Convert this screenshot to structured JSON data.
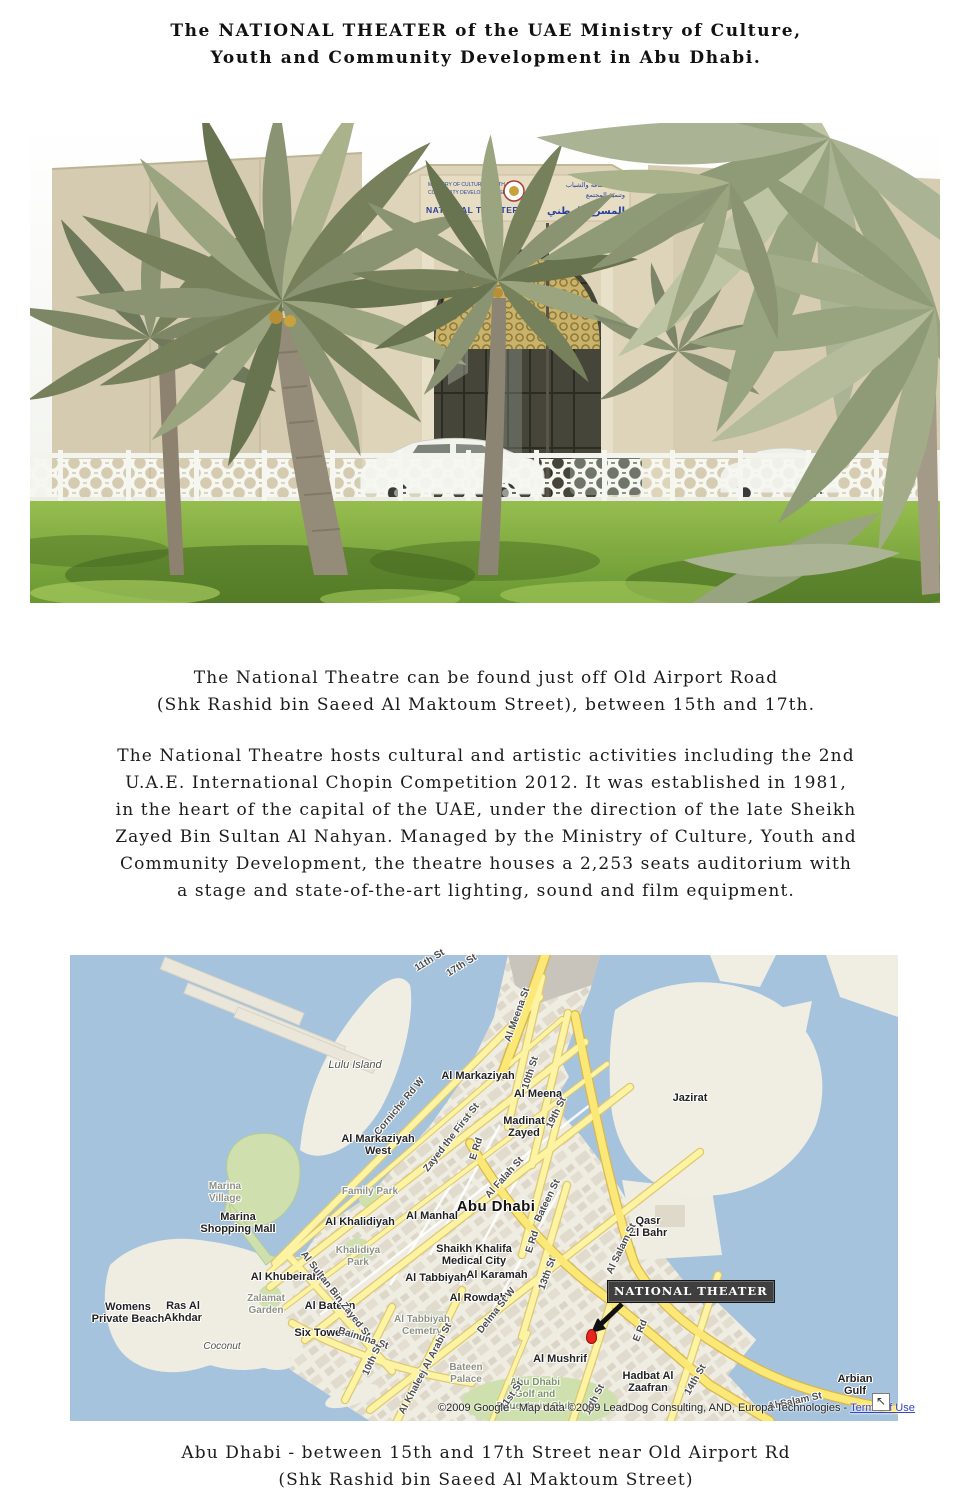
{
  "title": {
    "line1": "The NATIONAL THEATER of the UAE Ministry of Culture,",
    "line2": "Youth and Community Development in Abu Dhabi."
  },
  "intro": {
    "line1": "The National Theatre can be found just off Old Airport Road",
    "line2": "(Shk Rashid bin Saeed Al Maktoum Street), between 15th and 17th."
  },
  "body": {
    "line1": "The National Theatre hosts cultural and artistic activities including the 2nd",
    "line2": "U.A.E. International Chopin Competition 2012. It was established in 1981,",
    "line3": "in the heart of the capital of the UAE, under the direction of the late Sheikh",
    "line4": "Zayed Bin Sultan Al Nahyan. Managed by the Ministry of Culture, Youth and",
    "line5": "Community Development, the theatre houses a 2,253 seats auditorium with",
    "line6": "a stage and state-of-the-art lighting, sound and film equipment."
  },
  "caption": {
    "line1": "Abu Dhabi - between 15th and 17th Street near Old Airport Rd",
    "line2": "(Shk Rashid bin Saeed Al Maktoum Street)"
  },
  "photo": {
    "sign": {
      "ministry_line1": "MINISTRY OF CULTURE, YOUTH &",
      "ministry_line2": "COMMUNITY DEVELOPMENT SECTOR",
      "title_en": "NATIONAL THEATER",
      "ministry_ar_line1": "وزارة الثقافة والشباب",
      "ministry_ar_line2": "وتنمية المجتمع",
      "title_ar": "المسرح الوطني"
    },
    "colors": {
      "building": "#d5ccb1",
      "sky": "#f4f5ee",
      "grass": "#7ca63a",
      "palm": "#8a9372"
    }
  },
  "map": {
    "theater_label": "NATIONAL THEATER",
    "marker_color": "#e8251d",
    "water_color": "#a5c3dd",
    "land_color": "#efece2",
    "road_color": "#fdf3a2",
    "copyright": {
      "text": "©2009 Google - Map data ©2009 LeadDog Consulting, AND, Europa Technologies - ",
      "link": "Terms of Use"
    },
    "expand_icon": "↖",
    "labels": [
      {
        "t": "Lulu Island",
        "x": 285,
        "y": 110,
        "r": 0,
        "k": "italic"
      },
      {
        "t": "Jazirat",
        "x": 620,
        "y": 143,
        "r": 0,
        "k": ""
      },
      {
        "t": "Al Markaziyah",
        "x": 408,
        "y": 121,
        "r": 0,
        "k": ""
      },
      {
        "t": "Al Meena",
        "x": 468,
        "y": 139,
        "r": 0,
        "k": ""
      },
      {
        "t": "Madinat\nZayed",
        "x": 454,
        "y": 172,
        "r": 0,
        "k": ""
      },
      {
        "t": "Al Markaziyah\nWest",
        "x": 308,
        "y": 190,
        "r": 0,
        "k": ""
      },
      {
        "t": "Abu Dhabi",
        "x": 426,
        "y": 252,
        "r": 0,
        "k": "city"
      },
      {
        "t": "Al Khalidiyah",
        "x": 290,
        "y": 267,
        "r": 0,
        "k": ""
      },
      {
        "t": "Al Manhal",
        "x": 362,
        "y": 261,
        "r": 0,
        "k": ""
      },
      {
        "t": "Shaikh Khalifa\nMedical City",
        "x": 404,
        "y": 300,
        "r": 0,
        "k": ""
      },
      {
        "t": "Qasr\nEl Bahr",
        "x": 578,
        "y": 272,
        "r": 0,
        "k": ""
      },
      {
        "t": "Al Khubeirah",
        "x": 215,
        "y": 322,
        "r": 0,
        "k": ""
      },
      {
        "t": "Al Tabbiyah",
        "x": 366,
        "y": 323,
        "r": 0,
        "k": ""
      },
      {
        "t": "Al Karamah",
        "x": 427,
        "y": 320,
        "r": 0,
        "k": ""
      },
      {
        "t": "Al Rowdah",
        "x": 408,
        "y": 343,
        "r": 0,
        "k": ""
      },
      {
        "t": "Al Bateen",
        "x": 260,
        "y": 351,
        "r": 0,
        "k": ""
      },
      {
        "t": "Six Towers",
        "x": 253,
        "y": 378,
        "r": 0,
        "k": ""
      },
      {
        "t": "Al Mushrif",
        "x": 490,
        "y": 404,
        "r": 0,
        "k": ""
      },
      {
        "t": "Hadbat Al\nZaafran",
        "x": 578,
        "y": 427,
        "r": 0,
        "k": ""
      },
      {
        "t": "Womens\nPrivate Beach",
        "x": 58,
        "y": 358,
        "r": 0,
        "k": ""
      },
      {
        "t": "Ras Al\nAkhdar",
        "x": 113,
        "y": 357,
        "r": 0,
        "k": ""
      },
      {
        "t": "Arbian Gulf",
        "x": 785,
        "y": 430,
        "r": 0,
        "k": ""
      },
      {
        "t": "Marina\nVillage",
        "x": 155,
        "y": 238,
        "r": 0,
        "k": "park"
      },
      {
        "t": "Marina\nShopping Mall",
        "x": 168,
        "y": 268,
        "r": 0,
        "k": ""
      },
      {
        "t": "Family Park",
        "x": 300,
        "y": 237,
        "r": 0,
        "k": "park"
      },
      {
        "t": "Khalidiya\nPark",
        "x": 288,
        "y": 302,
        "r": 0,
        "k": "park"
      },
      {
        "t": "Zalamat\nGarden",
        "x": 196,
        "y": 350,
        "r": 0,
        "k": "park"
      },
      {
        "t": "Coconut",
        "x": 152,
        "y": 392,
        "r": 0,
        "k": "park italic"
      },
      {
        "t": "Al Tabbiyah\nCemetry",
        "x": 352,
        "y": 371,
        "r": 0,
        "k": "park"
      },
      {
        "t": "Bateen\nPalace",
        "x": 396,
        "y": 419,
        "r": 0,
        "k": "park"
      },
      {
        "t": "Abu Dhabi\nGolf and\nEquestrain Club",
        "x": 465,
        "y": 440,
        "r": 0,
        "k": "green"
      },
      {
        "t": "11th St",
        "x": 360,
        "y": 6,
        "r": -32,
        "k": "street"
      },
      {
        "t": "17th St",
        "x": 392,
        "y": 11,
        "r": -32,
        "k": "street"
      },
      {
        "t": "Al Meena St",
        "x": 448,
        "y": 60,
        "r": -70,
        "k": "street"
      },
      {
        "t": "10th St",
        "x": 461,
        "y": 118,
        "r": -72,
        "k": "street"
      },
      {
        "t": "19th St",
        "x": 487,
        "y": 158,
        "r": -64,
        "k": "street"
      },
      {
        "t": "Corniche Rd W",
        "x": 330,
        "y": 152,
        "r": -50,
        "k": "street"
      },
      {
        "t": "Zayed the First St",
        "x": 382,
        "y": 183,
        "r": -52,
        "k": "street"
      },
      {
        "t": "E Rd",
        "x": 407,
        "y": 194,
        "r": -72,
        "k": "street"
      },
      {
        "t": "Al Falah St",
        "x": 435,
        "y": 223,
        "r": -48,
        "k": "street"
      },
      {
        "t": "Bateen St",
        "x": 478,
        "y": 246,
        "r": -64,
        "k": "street"
      },
      {
        "t": "Al Salam St",
        "x": 552,
        "y": 294,
        "r": -64,
        "k": "street"
      },
      {
        "t": "E Rd",
        "x": 463,
        "y": 287,
        "r": -72,
        "k": "street"
      },
      {
        "t": "13th St",
        "x": 478,
        "y": 319,
        "r": -70,
        "k": "street"
      },
      {
        "t": "Delma St W",
        "x": 427,
        "y": 356,
        "r": -52,
        "k": "street"
      },
      {
        "t": "Al Sultan Bin Zayed St",
        "x": 265,
        "y": 340,
        "r": 52,
        "k": "street"
      },
      {
        "t": "Bainuna St",
        "x": 293,
        "y": 384,
        "r": 18,
        "k": "street"
      },
      {
        "t": "10th St",
        "x": 303,
        "y": 405,
        "r": -65,
        "k": "street"
      },
      {
        "t": "Al Khaleej Al Arabi St",
        "x": 356,
        "y": 414,
        "r": -62,
        "k": "street"
      },
      {
        "t": "E Rd",
        "x": 571,
        "y": 376,
        "r": -68,
        "k": "street"
      },
      {
        "t": "14th St",
        "x": 626,
        "y": 425,
        "r": -60,
        "k": "street"
      },
      {
        "t": "11th St",
        "x": 525,
        "y": 445,
        "r": -62,
        "k": "street"
      },
      {
        "t": "21st St",
        "x": 442,
        "y": 441,
        "r": -55,
        "k": "street"
      },
      {
        "t": "Al Salam St",
        "x": 725,
        "y": 447,
        "r": -12,
        "k": "street"
      }
    ]
  }
}
